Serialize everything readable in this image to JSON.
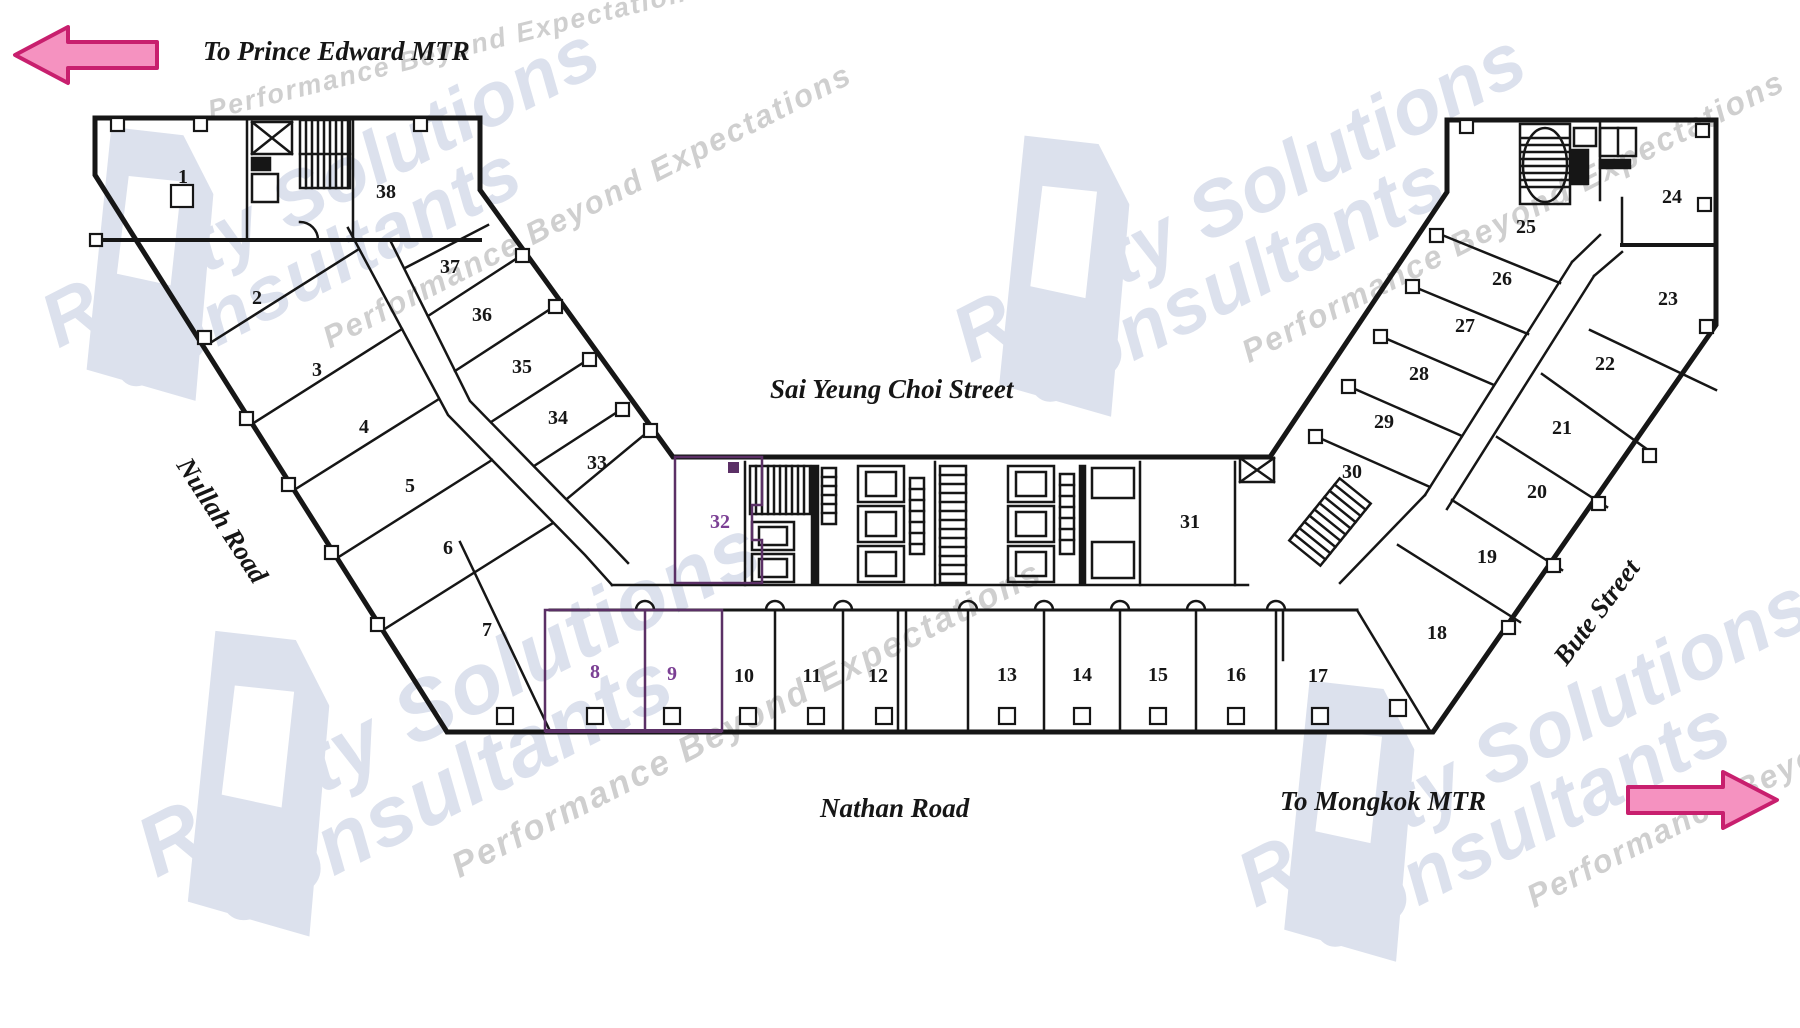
{
  "labels": {
    "to_prince_edward": "To Prince Edward MTR",
    "to_mongkok": "To Mongkok MTR",
    "sai_yeung_choi": "Sai Yeung Choi Street",
    "nathan_road": "Nathan Road",
    "nullah_road": "Nullah Road",
    "bute_street": "Bute Street"
  },
  "watermark": {
    "line1": "Realty Solutions",
    "line2": "Consultants",
    "tagline": "Performance Beyond Expectations"
  },
  "units": [
    {
      "n": "1",
      "x": 183,
      "y": 177
    },
    {
      "n": "2",
      "x": 257,
      "y": 298
    },
    {
      "n": "3",
      "x": 317,
      "y": 370
    },
    {
      "n": "4",
      "x": 364,
      "y": 427
    },
    {
      "n": "5",
      "x": 410,
      "y": 486
    },
    {
      "n": "6",
      "x": 448,
      "y": 548
    },
    {
      "n": "7",
      "x": 487,
      "y": 630
    },
    {
      "n": "8",
      "x": 595,
      "y": 672,
      "accent": true
    },
    {
      "n": "9",
      "x": 672,
      "y": 674,
      "accent": true
    },
    {
      "n": "10",
      "x": 744,
      "y": 676
    },
    {
      "n": "11",
      "x": 812,
      "y": 676
    },
    {
      "n": "12",
      "x": 878,
      "y": 676
    },
    {
      "n": "13",
      "x": 1007,
      "y": 675
    },
    {
      "n": "14",
      "x": 1082,
      "y": 675
    },
    {
      "n": "15",
      "x": 1158,
      "y": 675
    },
    {
      "n": "16",
      "x": 1236,
      "y": 675
    },
    {
      "n": "17",
      "x": 1318,
      "y": 676
    },
    {
      "n": "18",
      "x": 1437,
      "y": 633
    },
    {
      "n": "19",
      "x": 1487,
      "y": 557
    },
    {
      "n": "20",
      "x": 1537,
      "y": 492
    },
    {
      "n": "21",
      "x": 1562,
      "y": 428
    },
    {
      "n": "22",
      "x": 1605,
      "y": 364
    },
    {
      "n": "23",
      "x": 1668,
      "y": 299
    },
    {
      "n": "24",
      "x": 1672,
      "y": 197
    },
    {
      "n": "25",
      "x": 1526,
      "y": 227
    },
    {
      "n": "26",
      "x": 1502,
      "y": 279
    },
    {
      "n": "27",
      "x": 1465,
      "y": 326
    },
    {
      "n": "28",
      "x": 1419,
      "y": 374
    },
    {
      "n": "29",
      "x": 1384,
      "y": 422
    },
    {
      "n": "30",
      "x": 1352,
      "y": 472
    },
    {
      "n": "31",
      "x": 1190,
      "y": 522
    },
    {
      "n": "32",
      "x": 720,
      "y": 522,
      "accent": true
    },
    {
      "n": "33",
      "x": 597,
      "y": 463
    },
    {
      "n": "34",
      "x": 558,
      "y": 418
    },
    {
      "n": "35",
      "x": 522,
      "y": 367
    },
    {
      "n": "36",
      "x": 482,
      "y": 315
    },
    {
      "n": "37",
      "x": 450,
      "y": 267
    },
    {
      "n": "38",
      "x": 386,
      "y": 192
    }
  ],
  "colors": {
    "ink": "#161616",
    "accent": "#7b3f94",
    "accent_wall": "#5b3066",
    "arrow_fill": "#f592c0",
    "arrow_stroke": "#c81f6e",
    "watermark": "#dce1ed",
    "watermark_tagline": "#cfcfcf"
  }
}
